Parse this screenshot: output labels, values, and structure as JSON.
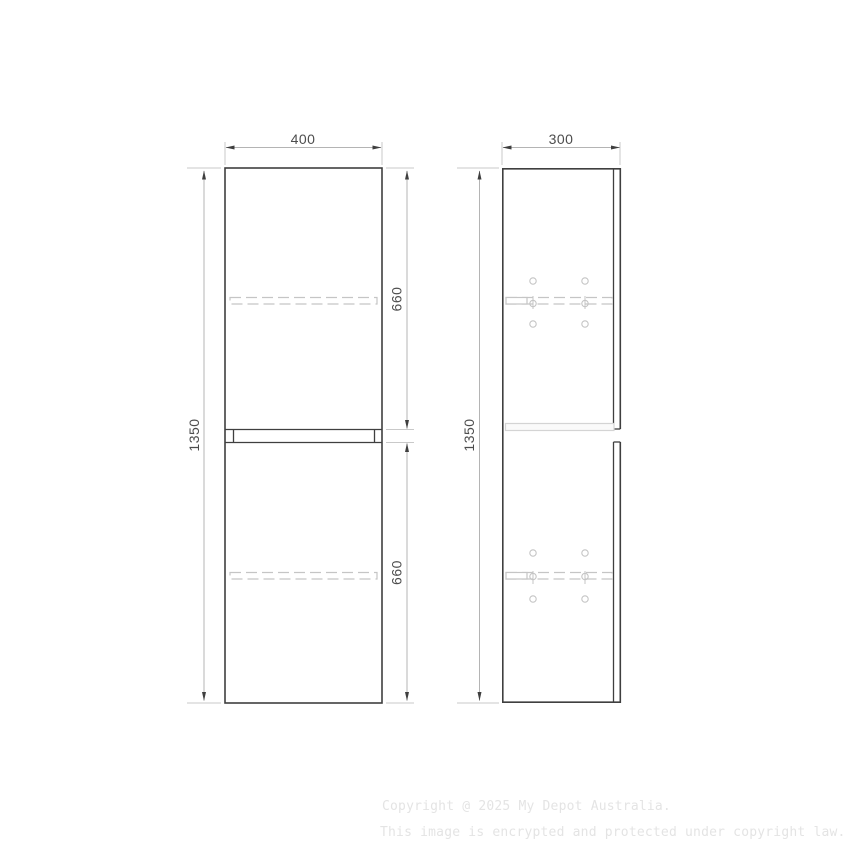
{
  "dimensions": {
    "front": {
      "width": "400",
      "height": "1350",
      "upper_door": "660",
      "lower_door": "660"
    },
    "side": {
      "width": "300",
      "height": "1350"
    }
  },
  "watermark": {
    "line1": "Copyright @ 2025 My Depot Australia.",
    "line2": "This image is encrypted and protected under copyright law."
  },
  "colors": {
    "background": "#ffffff",
    "line-dark": "#3f3f3f",
    "dim-line": "#b4b4b4",
    "ext-line": "#c9c9c9",
    "detail-light": "#c5c5c5",
    "shelf-band": "#d4d4d4",
    "dim-text": "#4d4d4d",
    "watermark-text": "#e4e4e4"
  }
}
